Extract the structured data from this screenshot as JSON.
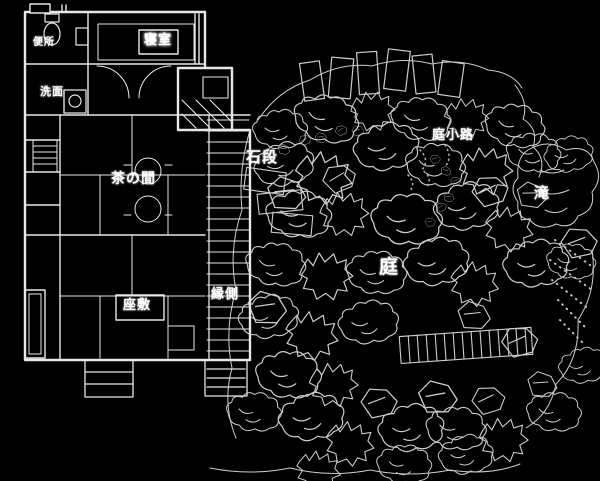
{
  "canvas": {
    "background_color": "#000000",
    "line_color": "#e6e6e6"
  },
  "labels": {
    "toilet": "便所",
    "washroom": "洗面",
    "bedroom": "寝室",
    "tea_room": "茶の間",
    "zashiki": "座敷",
    "engawa": "縁側",
    "stone_steps": "石段",
    "garden_path": "庭小路",
    "garden": "庭",
    "waterfall": "滝"
  }
}
